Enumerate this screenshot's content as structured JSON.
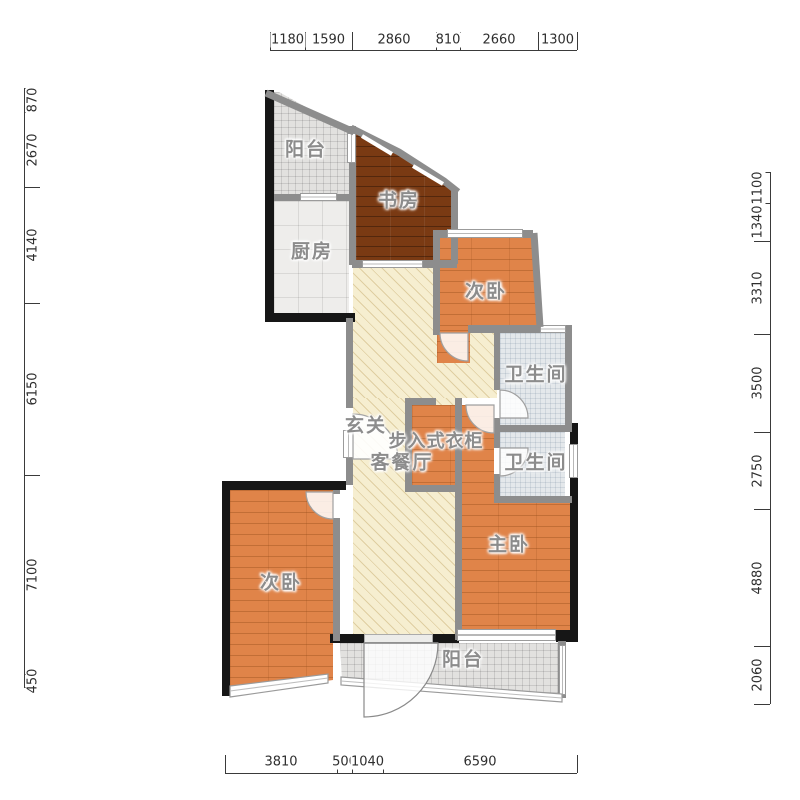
{
  "plan": {
    "rooms": {
      "balcony_top": {
        "label": "阳台"
      },
      "study": {
        "label": "书房"
      },
      "kitchen": {
        "label": "厨房"
      },
      "bedroom_top": {
        "label": "次卧"
      },
      "bath_top": {
        "label": "卫生间"
      },
      "entry": {
        "label": "玄关"
      },
      "closet": {
        "label": "步入式衣柜"
      },
      "living": {
        "label": "客餐厅"
      },
      "bath_bottom": {
        "label": "卫生间"
      },
      "master": {
        "label": "主卧"
      },
      "bedroom_bottom": {
        "label": "次卧"
      },
      "balcony_bottom": {
        "label": "阳台"
      }
    },
    "dimensions": {
      "top": [
        "1180",
        "1590",
        "2860",
        "810",
        "2660",
        "1300"
      ],
      "left": [
        "870",
        "2670",
        "4140",
        "6150",
        "7100",
        "450"
      ],
      "right": [
        "1100",
        "1340",
        "3310",
        "3500",
        "2750",
        "4880",
        "2060"
      ],
      "bottom": [
        "3810",
        "500",
        "1040",
        "6590"
      ]
    }
  },
  "colors": {
    "wood": "#e08449",
    "wood_dark": "#7a3a13",
    "hall": "#f6eed0",
    "wall": "#8d8d8d",
    "wall_dark": "#161616"
  }
}
